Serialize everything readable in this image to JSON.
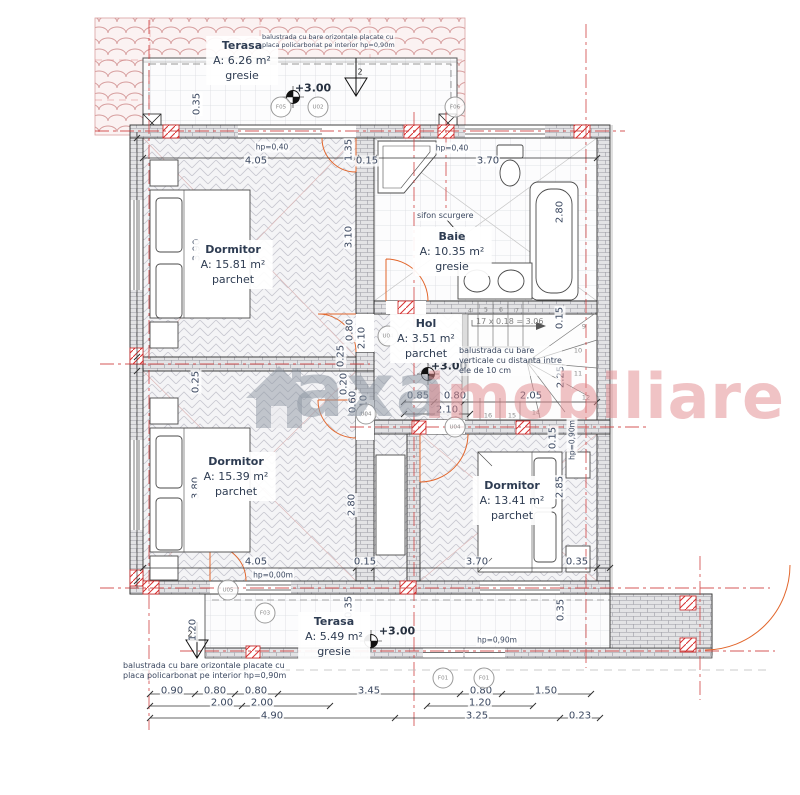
{
  "watermark": {
    "logo": "axa",
    "word": "imobiliare"
  },
  "rooms": [
    {
      "name": "Terasa",
      "area": "A: 6.26 m²",
      "finish": "gresie",
      "x": 242,
      "y": 36
    },
    {
      "name": "Dormitor",
      "area": "A: 15.81 m²",
      "finish": "parchet",
      "x": 233,
      "y": 240
    },
    {
      "name": "Baie",
      "area": "A: 10.35 m²",
      "finish": "gresie",
      "x": 452,
      "y": 227
    },
    {
      "name": "Hol",
      "area": "A: 3.51 m²",
      "finish": "parchet",
      "x": 426,
      "y": 314
    },
    {
      "name": "Dormitor",
      "area": "A: 15.39 m²",
      "finish": "parchet",
      "x": 236,
      "y": 452
    },
    {
      "name": "Dormitor",
      "area": "A: 13.41 m²",
      "finish": "parchet",
      "x": 512,
      "y": 476
    },
    {
      "name": "Terasa",
      "area": "A: 5.49 m²",
      "finish": "gresie",
      "x": 334,
      "y": 612
    }
  ],
  "labels": [
    {
      "t": "0.35",
      "x": 197,
      "y": 104,
      "r": 1
    },
    {
      "t": "4.05",
      "x": 256,
      "y": 161
    },
    {
      "t": "0.15",
      "x": 367,
      "y": 161
    },
    {
      "t": "3.70",
      "x": 488,
      "y": 161
    },
    {
      "t": "1.35",
      "x": 349,
      "y": 150,
      "r": 1
    },
    {
      "t": "3.90",
      "x": 197,
      "y": 250,
      "r": 1
    },
    {
      "t": "3.10",
      "x": 349,
      "y": 237,
      "r": 1
    },
    {
      "t": "2.80",
      "x": 560,
      "y": 212,
      "r": 1
    },
    {
      "t": "0.15",
      "x": 560,
      "y": 318,
      "r": 1
    },
    {
      "t": "2.25",
      "x": 561,
      "y": 377,
      "r": 1
    },
    {
      "t": "0.85",
      "x": 418,
      "y": 396
    },
    {
      "t": "0.80",
      "x": 455,
      "y": 396
    },
    {
      "t": "2.10",
      "x": 447,
      "y": 410
    },
    {
      "t": "2.05",
      "x": 531,
      "y": 396
    },
    {
      "t": "0.80",
      "x": 350,
      "y": 330,
      "r": 1
    },
    {
      "t": "2.10",
      "x": 362,
      "y": 338,
      "r": 1
    },
    {
      "t": "0.25",
      "x": 341,
      "y": 356,
      "r": 1
    },
    {
      "t": "0.20",
      "x": 344,
      "y": 384,
      "r": 1
    },
    {
      "t": "0.60",
      "x": 353,
      "y": 402,
      "r": 1
    },
    {
      "t": "2.10",
      "x": 364,
      "y": 406,
      "r": 1
    },
    {
      "t": "0.25",
      "x": 196,
      "y": 382,
      "r": 1
    },
    {
      "t": "3.80",
      "x": 196,
      "y": 488,
      "r": 1
    },
    {
      "t": "2.80",
      "x": 352,
      "y": 505,
      "r": 1
    },
    {
      "t": "2.85",
      "x": 560,
      "y": 487,
      "r": 1
    },
    {
      "t": "0.15",
      "x": 553,
      "y": 438,
      "r": 1
    },
    {
      "t": "4.05",
      "x": 256,
      "y": 562
    },
    {
      "t": "0.15",
      "x": 365,
      "y": 562
    },
    {
      "t": "3.70",
      "x": 477,
      "y": 562
    },
    {
      "t": "0.35",
      "x": 577,
      "y": 562
    },
    {
      "t": "0.35",
      "x": 349,
      "y": 607,
      "r": 1
    },
    {
      "t": "1.20",
      "x": 193,
      "y": 630,
      "r": 1
    },
    {
      "t": "0.35",
      "x": 561,
      "y": 610,
      "r": 1
    },
    {
      "t": "0.90",
      "x": 172,
      "y": 691
    },
    {
      "t": "0.80",
      "x": 215,
      "y": 691
    },
    {
      "t": "0.80",
      "x": 256,
      "y": 691
    },
    {
      "t": "3.45",
      "x": 369,
      "y": 691
    },
    {
      "t": "0.80",
      "x": 481,
      "y": 691
    },
    {
      "t": "1.50",
      "x": 546,
      "y": 691
    },
    {
      "t": "2.00",
      "x": 222,
      "y": 703
    },
    {
      "t": "2.00",
      "x": 262,
      "y": 703
    },
    {
      "t": "1.20",
      "x": 480,
      "y": 703
    },
    {
      "t": "4.90",
      "x": 272,
      "y": 716
    },
    {
      "t": "3.25",
      "x": 477,
      "y": 716
    },
    {
      "t": "0.23",
      "x": 580,
      "y": 716
    },
    {
      "t": "hp=0,40",
      "x": 272,
      "y": 147,
      "c": "hp"
    },
    {
      "t": "hp=0,40",
      "x": 452,
      "y": 148,
      "c": "hp"
    },
    {
      "t": "hp=0,00m",
      "x": 273,
      "y": 575,
      "c": "hp"
    },
    {
      "t": "hp=0,90m",
      "x": 497,
      "y": 640,
      "c": "hp"
    },
    {
      "t": "hp=0,90m",
      "x": 572,
      "y": 440,
      "r": 1,
      "c": "hp"
    },
    {
      "t": "+3.00",
      "x": 313,
      "y": 88,
      "c": "level"
    },
    {
      "t": "+3.00",
      "x": 449,
      "y": 366,
      "c": "level"
    },
    {
      "t": "+3.00",
      "x": 397,
      "y": 631,
      "c": "level"
    },
    {
      "t": "2",
      "x": 360,
      "y": 72,
      "c": "sec"
    },
    {
      "t": "2",
      "x": 190,
      "y": 634,
      "c": "sec"
    },
    {
      "t": "4",
      "x": 470,
      "y": 311,
      "c": "snum"
    },
    {
      "t": "5",
      "x": 486,
      "y": 310,
      "c": "snum"
    },
    {
      "t": "6",
      "x": 501,
      "y": 310,
      "c": "snum"
    },
    {
      "t": "7",
      "x": 517,
      "y": 311,
      "c": "snum"
    },
    {
      "t": "9",
      "x": 584,
      "y": 327,
      "c": "snum"
    },
    {
      "t": "10",
      "x": 578,
      "y": 351,
      "c": "snum"
    },
    {
      "t": "11",
      "x": 578,
      "y": 374,
      "c": "snum"
    },
    {
      "t": "12",
      "x": 586,
      "y": 398,
      "c": "snum"
    },
    {
      "t": "14",
      "x": 536,
      "y": 413,
      "c": "snum"
    },
    {
      "t": "15",
      "x": 512,
      "y": 416,
      "c": "snum"
    },
    {
      "t": "16",
      "x": 488,
      "y": 416,
      "c": "snum"
    }
  ],
  "markers": [
    {
      "id": "F05",
      "x": 281,
      "y": 107
    },
    {
      "id": "U02",
      "x": 318,
      "y": 107
    },
    {
      "id": "F06",
      "x": 455,
      "y": 107
    },
    {
      "id": "U04",
      "x": 388,
      "y": 336
    },
    {
      "id": "U04",
      "x": 366,
      "y": 414
    },
    {
      "id": "U04",
      "x": 455,
      "y": 427
    },
    {
      "id": "U05",
      "x": 228,
      "y": 590
    },
    {
      "id": "F03",
      "x": 265,
      "y": 613
    },
    {
      "id": "F01",
      "x": 443,
      "y": 678
    },
    {
      "id": "F01",
      "x": 484,
      "y": 678
    }
  ],
  "notes": [
    {
      "x": 262,
      "y": 33,
      "cls": "tiny",
      "lines": [
        "balustrada cu bare orizontale placate cu",
        "placa policarbonat pe interior hp=0,90m"
      ]
    },
    {
      "x": 476,
      "y": 317,
      "cls": "gray",
      "lines": [
        "17 x 0.18 = 3.06"
      ]
    },
    {
      "x": 459,
      "y": 346,
      "cls": "",
      "lines": [
        "balustrada cu bare",
        "verticale cu distanta intre",
        "ele de 10 cm"
      ]
    },
    {
      "x": 417,
      "y": 211,
      "cls": "",
      "lines": [
        "sifon scurgere"
      ]
    },
    {
      "x": 123,
      "y": 661,
      "cls": "",
      "lines": [
        "balustrada cu bare orizontale placate cu",
        "placa policarbonat pe interior hp=0,90m"
      ]
    }
  ],
  "colors": {
    "axis": "#cf3a3a",
    "door": "#e2662c",
    "dim_text": "#3b4860",
    "watermark_gray": "#8f98a4",
    "watermark_pink": "#e2898d"
  }
}
